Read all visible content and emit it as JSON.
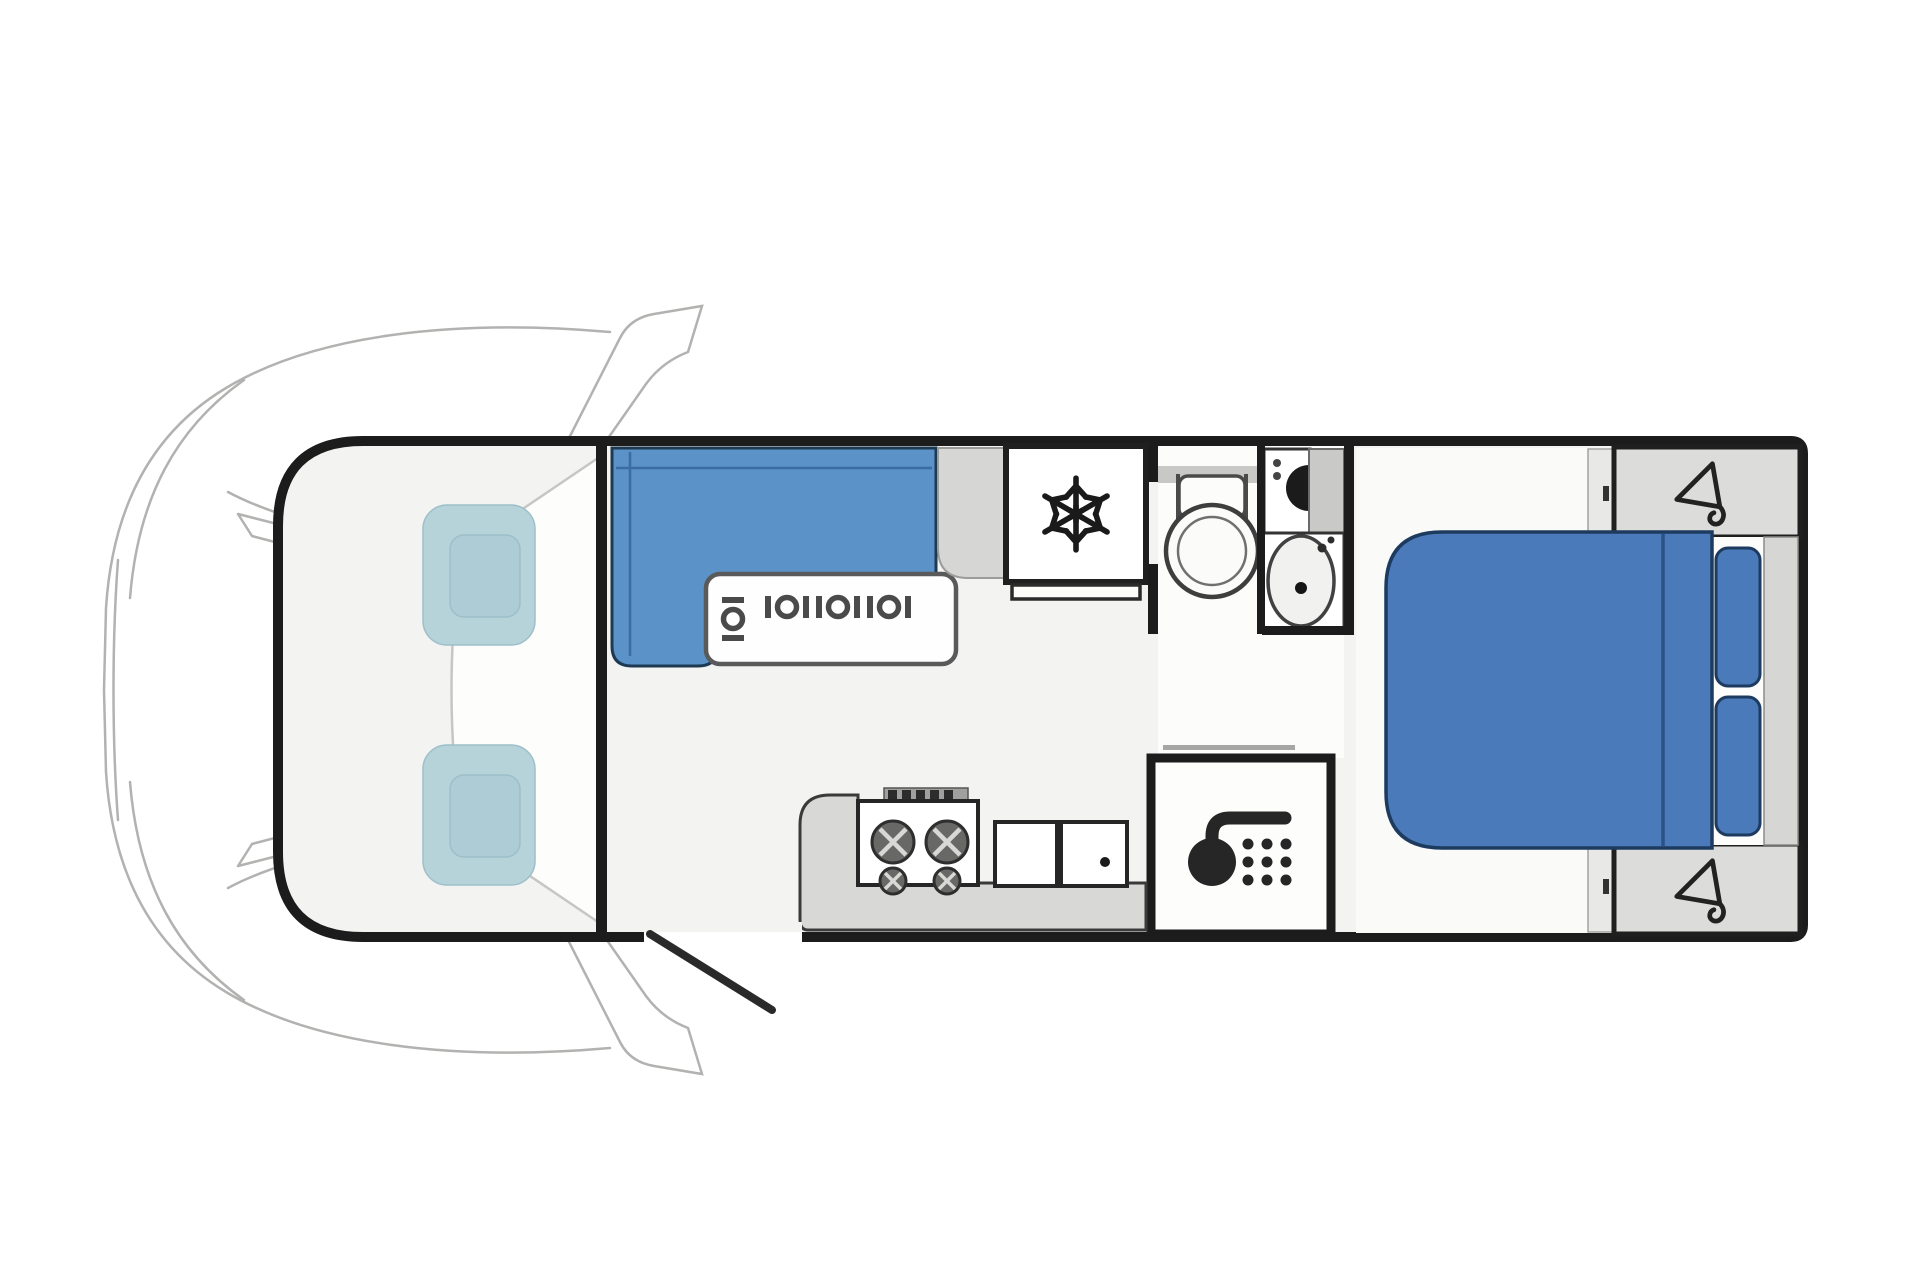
{
  "meta": {
    "document_type": "motorhome floor plan diagram",
    "orientation": "top-down plan, cab at left, rear bedroom at right",
    "visible_text": "none"
  },
  "colors": {
    "background": "#ffffff",
    "body_outline": "#1c1c1c",
    "floor": "#f3f3f1",
    "bedroom_floor": "#fafaf8",
    "cab_seat": "#b7d3da",
    "cab_seat_inner": "#adccd5",
    "lounge_seat": "#5b92c8",
    "bed": "#4a7ab9",
    "bed_edge": "#1d3a5f",
    "cabinet_gray": "#d6d6d4",
    "wardrobe_gray": "#dcdcda",
    "counter_gray": "#d8d8d6",
    "icon_dark": "#262626",
    "line_art_gray": "#b2b2b0"
  },
  "rooms": {
    "cab": {
      "label": "Driver cab",
      "seats": [
        "passenger swivel seat",
        "driver swivel seat"
      ],
      "features": [
        "wing mirrors",
        "windscreen",
        "vehicle nose line art"
      ]
    },
    "lounge": {
      "label": "L-shaped front lounge",
      "table": "dinette table",
      "seatbelt_positions": 4,
      "icon": "seatbelt-anchor-icon"
    },
    "storage_front": {
      "label": "cabinet beside fridge"
    },
    "fridge": {
      "label": "Fridge / freezer",
      "icon": "snowflake-icon"
    },
    "kitchen": {
      "label": "Rear kitchen galley",
      "hob_burners": 4,
      "sink_bowls": 2,
      "features": [
        "control knobs",
        "worktop"
      ]
    },
    "bathroom": {
      "label": "Washroom",
      "fixtures": [
        "toilet",
        "vanity with tap",
        "oval washbasin"
      ]
    },
    "hallway": {
      "label": "Corridor with sliding door track"
    },
    "shower": {
      "label": "Separate shower cubicle",
      "icon": "shower-head-icon"
    },
    "bedroom": {
      "label": "Rear island-bed bedroom",
      "bed": "island double bed",
      "pillows": 2,
      "wardrobes": 2,
      "icon": "clothes-hanger-icon"
    },
    "entry": {
      "label": "Habitation entry door shown open",
      "icon": "open-door-swing-line"
    }
  }
}
